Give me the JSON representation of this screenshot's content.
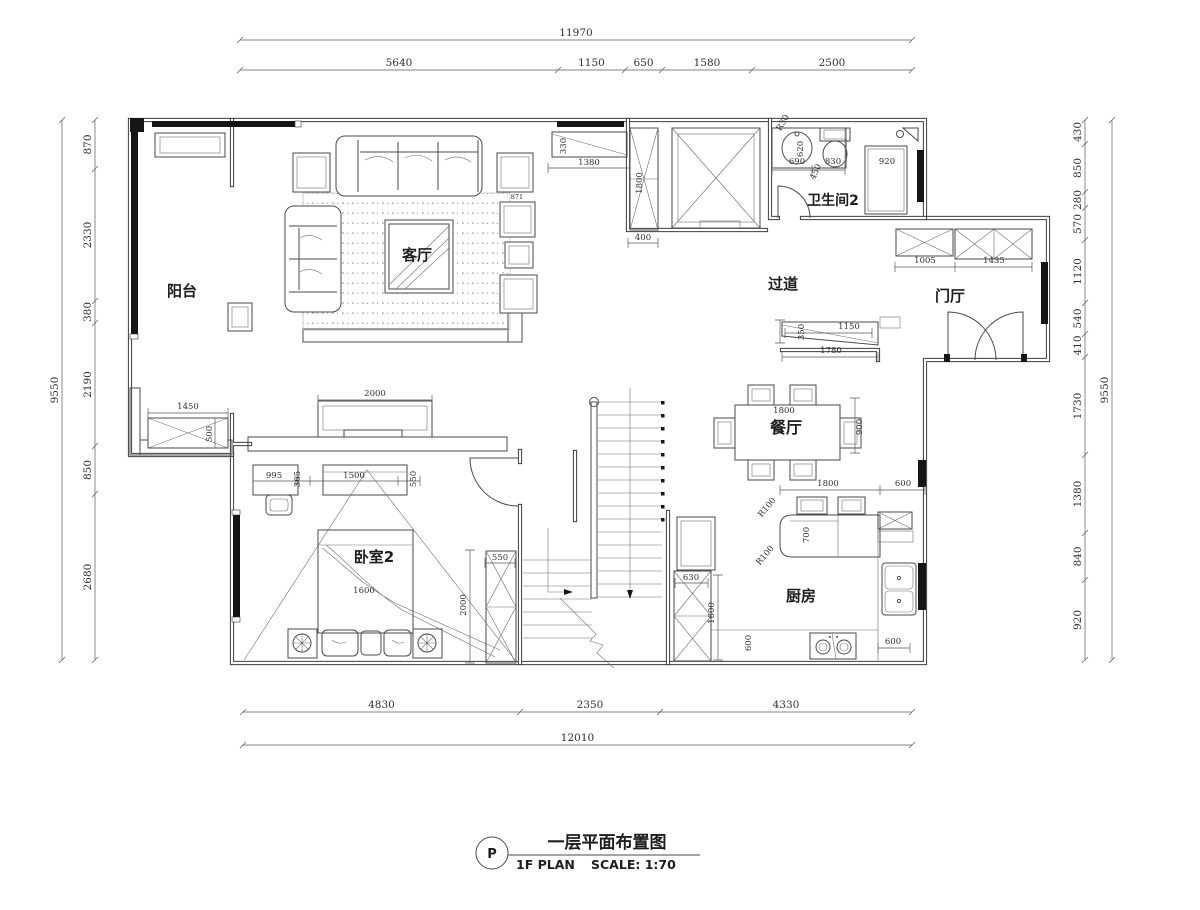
{
  "title": {
    "bubble_letter": "P",
    "cn": "一层平面布置图",
    "en": "1F PLAN",
    "scale": "SCALE: 1:70"
  },
  "colors": {
    "paper": "#ffffff",
    "line": "#3d3d3d",
    "window": "#161616",
    "text": "#2f2f2f"
  },
  "rooms": [
    {
      "name": "room-label-balcony",
      "text": "阳台",
      "x": 182,
      "y": 296,
      "size": 15
    },
    {
      "name": "room-label-living",
      "text": "客厅",
      "x": 417,
      "y": 260,
      "size": 15
    },
    {
      "name": "room-label-corridor",
      "text": "过道",
      "x": 783,
      "y": 289,
      "size": 15
    },
    {
      "name": "room-label-bath2",
      "text": "卫生间2",
      "x": 833,
      "y": 205,
      "size": 14
    },
    {
      "name": "room-label-foyer",
      "text": "门厅",
      "x": 950,
      "y": 301,
      "size": 15
    },
    {
      "name": "room-label-dining",
      "text": "餐厅",
      "x": 786,
      "y": 433,
      "size": 16
    },
    {
      "name": "room-label-bedroom2",
      "text": "卧室2",
      "x": 374,
      "y": 562,
      "size": 15
    },
    {
      "name": "room-label-kitchen",
      "text": "厨房",
      "x": 801,
      "y": 601,
      "size": 15
    }
  ],
  "annotations": [
    {
      "name": "dim-top-cabinet-1380",
      "text": "1380",
      "x": 589,
      "y": 165
    },
    {
      "name": "dim-top-cabinet-330",
      "text": "330",
      "x": 566,
      "y": 146,
      "rot": -90
    },
    {
      "name": "dim-shaft-1800",
      "text": "1800",
      "x": 642,
      "y": 183,
      "rot": -90
    },
    {
      "name": "dim-shaft-400",
      "text": "400",
      "x": 643,
      "y": 240
    },
    {
      "name": "dim-bath-690",
      "text": "690",
      "x": 797,
      "y": 164
    },
    {
      "name": "dim-bath-830",
      "text": "830",
      "x": 833,
      "y": 164
    },
    {
      "name": "dim-bath-450",
      "text": "450",
      "x": 818,
      "y": 173,
      "rot": -65
    },
    {
      "name": "dim-bath-620",
      "text": "620",
      "x": 803,
      "y": 149,
      "rot": -90
    },
    {
      "name": "dim-bath-R30",
      "text": "R30",
      "x": 785,
      "y": 124,
      "rot": -60
    },
    {
      "name": "dim-bath-920",
      "text": "920",
      "x": 887,
      "y": 164
    },
    {
      "name": "dim-foyer-1005",
      "text": "1005",
      "x": 925,
      "y": 263
    },
    {
      "name": "dim-foyer-1435",
      "text": "1435",
      "x": 994,
      "y": 263
    },
    {
      "name": "dim-corr-350",
      "text": "350",
      "x": 804,
      "y": 332,
      "rot": -90
    },
    {
      "name": "dim-corr-1150",
      "text": "1150",
      "x": 849,
      "y": 329
    },
    {
      "name": "dim-corr-1780",
      "text": "1780",
      "x": 831,
      "y": 353
    },
    {
      "name": "dim-balcony-1450",
      "text": "1450",
      "x": 188,
      "y": 409
    },
    {
      "name": "dim-balcony-500",
      "text": "500",
      "x": 212,
      "y": 434,
      "rot": -90
    },
    {
      "name": "dim-tvwall-2000",
      "text": "2000",
      "x": 375,
      "y": 396
    },
    {
      "name": "dim-bed-995",
      "text": "995",
      "x": 274,
      "y": 478
    },
    {
      "name": "dim-bed-365",
      "text": "365",
      "x": 300,
      "y": 479,
      "rot": -90
    },
    {
      "name": "dim-bed-1500",
      "text": "1500",
      "x": 354,
      "y": 478
    },
    {
      "name": "dim-bed-550",
      "text": "550",
      "x": 416,
      "y": 479,
      "rot": -90
    },
    {
      "name": "dim-bed-1600",
      "text": "1600",
      "x": 364,
      "y": 593
    },
    {
      "name": "dim-wardrobe-550",
      "text": "550",
      "x": 500,
      "y": 560
    },
    {
      "name": "dim-wardrobe-2000",
      "text": "2000",
      "x": 466,
      "y": 605,
      "rot": -90
    },
    {
      "name": "dim-dining-1800",
      "text": "1800",
      "x": 784,
      "y": 413
    },
    {
      "name": "dim-dining-900",
      "text": "900",
      "x": 862,
      "y": 427,
      "rot": -90
    },
    {
      "name": "dim-island-1800",
      "text": "1800",
      "x": 828,
      "y": 486
    },
    {
      "name": "dim-island-600",
      "text": "600",
      "x": 903,
      "y": 486
    },
    {
      "name": "dim-island-700",
      "text": "700",
      "x": 809,
      "y": 535,
      "rot": -90
    },
    {
      "name": "dim-island-R100a",
      "text": "R100",
      "x": 769,
      "y": 509,
      "rot": -50
    },
    {
      "name": "dim-island-R100b",
      "text": "R100",
      "x": 767,
      "y": 557,
      "rot": -50
    },
    {
      "name": "dim-cabinet-630",
      "text": "630",
      "x": 691,
      "y": 580
    },
    {
      "name": "dim-cabinet-1600",
      "text": "1600",
      "x": 714,
      "y": 613,
      "rot": -90
    },
    {
      "name": "dim-stove-600",
      "text": "600",
      "x": 751,
      "y": 643,
      "rot": -90
    },
    {
      "name": "dim-sink-600",
      "text": "600",
      "x": 893,
      "y": 644
    },
    {
      "name": "dim-chair-871",
      "text": "871",
      "x": 517,
      "y": 199,
      "size": 6.5
    }
  ],
  "dim_chains": [
    {
      "name": "dim-chain-top-total",
      "orient": "h",
      "pos": 40,
      "ticks": [
        240,
        912
      ],
      "values": [
        "11970"
      ]
    },
    {
      "name": "dim-chain-top-segments",
      "orient": "h",
      "pos": 70,
      "ticks": [
        240,
        558,
        625,
        662,
        752,
        912
      ],
      "values": [
        "5640",
        "1150",
        "650",
        "1580",
        "2500"
      ]
    },
    {
      "name": "dim-chain-left-total",
      "orient": "v",
      "pos": 62,
      "ticks": [
        120,
        660
      ],
      "values": [
        "9550"
      ]
    },
    {
      "name": "dim-chain-left-segments",
      "orient": "v",
      "pos": 95,
      "ticks": [
        120,
        169,
        301,
        323,
        446,
        494,
        660
      ],
      "values": [
        "870",
        "2330",
        "380",
        "2190",
        "850",
        "2680"
      ]
    },
    {
      "name": "dim-chain-right-segments",
      "orient": "v",
      "pos": 1085,
      "ticks": [
        120,
        144,
        192,
        208,
        240,
        303,
        334,
        357,
        455,
        533,
        580,
        660
      ],
      "values": [
        "430",
        "850",
        "280",
        "570",
        "1120",
        "540",
        "410",
        "1730",
        "1380",
        "840",
        "920"
      ]
    },
    {
      "name": "dim-chain-right-total",
      "orient": "v",
      "pos": 1112,
      "ticks": [
        120,
        660
      ],
      "values": [
        "9550"
      ]
    },
    {
      "name": "dim-chain-bottom-segments",
      "orient": "h",
      "pos": 712,
      "ticks": [
        243,
        520,
        660,
        912
      ],
      "values": [
        "4830",
        "2350",
        "4330"
      ]
    },
    {
      "name": "dim-chain-bottom-total",
      "orient": "h",
      "pos": 745,
      "ticks": [
        243,
        912
      ],
      "values": [
        "12010"
      ]
    }
  ]
}
